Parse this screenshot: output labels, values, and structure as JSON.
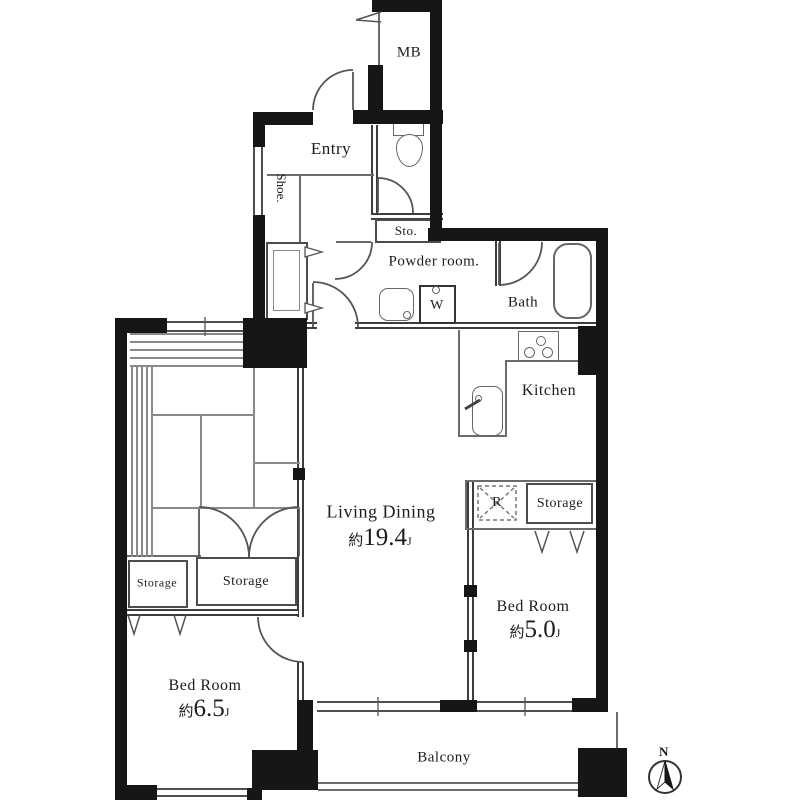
{
  "plan_type": "floor-plan",
  "rooms": {
    "meter_box": {
      "label": "MB"
    },
    "entry": {
      "label": "Entry"
    },
    "shoe": {
      "label": "Shoe."
    },
    "storage_small": {
      "label": "Sto."
    },
    "powder_room": {
      "label": "Powder room."
    },
    "washing_machine": {
      "label": "W"
    },
    "bath": {
      "label": "Bath"
    },
    "kitchen": {
      "label": "Kitchen"
    },
    "living_dining": {
      "label": "Living Dining",
      "area_prefix": "約",
      "area_value": "19.4",
      "area_unit": "J"
    },
    "refrigerator": {
      "label": "R"
    },
    "storage_east": {
      "label": "Storage"
    },
    "bedroom_east": {
      "label": "Bed Room",
      "area_prefix": "約",
      "area_value": "5.0",
      "area_unit": "J"
    },
    "storage_west_small": {
      "label": "Storage"
    },
    "storage_west": {
      "label": "Storage"
    },
    "bedroom_west": {
      "label": "Bed Room",
      "area_prefix": "約",
      "area_value": "6.5",
      "area_unit": "J"
    },
    "balcony": {
      "label": "Balcony"
    }
  },
  "compass": {
    "north_label": "N"
  },
  "icons": [
    "toilet-icon",
    "washbasin-icon",
    "washing-machine-icon",
    "bathtub-icon",
    "stove-icon",
    "kitchen-sink-icon",
    "refrigerator-dashed-icon",
    "door-arc-icon",
    "folding-door-icon",
    "compass-icon"
  ],
  "colors": {
    "wall": "#161616",
    "partition": "#3d3d3d",
    "fixture_line": "#666666",
    "text": "#1c1c1c",
    "background": "#ffffff"
  }
}
